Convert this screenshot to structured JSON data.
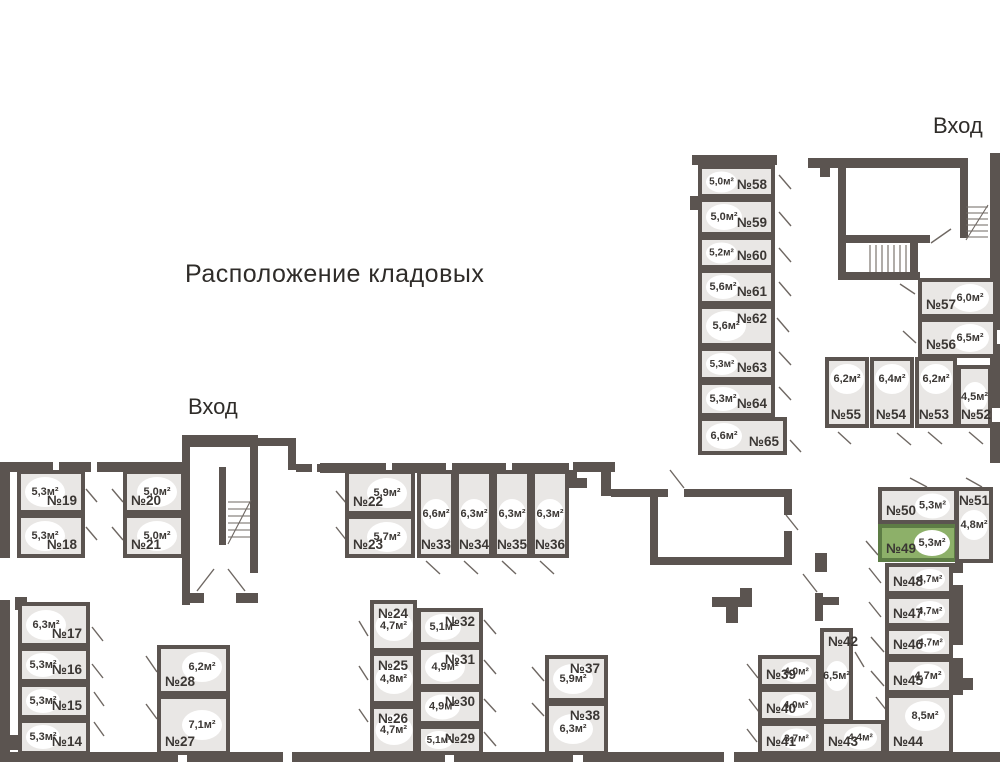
{
  "title": "Расположение кладовых",
  "entrances": {
    "top": "Вход",
    "left": "Вход"
  },
  "colors": {
    "wall": "#5b5450",
    "room_fill": "#e9e7e5",
    "selected_fill": "#8db069",
    "selected_border": "#5d7c45",
    "text": "#3b3734",
    "badge_fill": "#ffffff"
  },
  "selected_room": "№49",
  "rooms": [
    {
      "num": "№14",
      "area": "5,3м²",
      "x": 18,
      "y": 719,
      "w": 72,
      "h": 36,
      "np": "br",
      "ap": "cl"
    },
    {
      "num": "№15",
      "area": "5,3м²",
      "x": 18,
      "y": 683,
      "w": 72,
      "h": 36,
      "np": "br",
      "ap": "cl"
    },
    {
      "num": "№16",
      "area": "5,3м²",
      "x": 18,
      "y": 647,
      "w": 72,
      "h": 36,
      "np": "br",
      "ap": "cl"
    },
    {
      "num": "№17",
      "area": "6,3м²",
      "x": 18,
      "y": 602,
      "w": 72,
      "h": 45,
      "np": "br",
      "ap": "cl"
    },
    {
      "num": "№18",
      "area": "5,3м²",
      "x": 17,
      "y": 514,
      "w": 68,
      "h": 44,
      "np": "br",
      "ap": "cl"
    },
    {
      "num": "№19",
      "area": "5,3м²",
      "x": 17,
      "y": 470,
      "w": 68,
      "h": 44,
      "np": "br",
      "ap": "cl"
    },
    {
      "num": "№20",
      "area": "5,0м²",
      "x": 123,
      "y": 470,
      "w": 62,
      "h": 44,
      "np": "bl",
      "ap": "cr"
    },
    {
      "num": "№21",
      "area": "5,0м²",
      "x": 123,
      "y": 514,
      "w": 62,
      "h": 44,
      "np": "bl",
      "ap": "cr"
    },
    {
      "num": "№22",
      "area": "5,9м²",
      "x": 345,
      "y": 470,
      "w": 70,
      "h": 45,
      "np": "bl",
      "ap": "cr"
    },
    {
      "num": "№23",
      "area": "5,7м²",
      "x": 345,
      "y": 515,
      "w": 70,
      "h": 43,
      "np": "bl",
      "ap": "cr"
    },
    {
      "num": "№24",
      "area": "4,7м²",
      "x": 370,
      "y": 600,
      "w": 47,
      "h": 52,
      "np": "tl",
      "ap": "c"
    },
    {
      "num": "№25",
      "area": "4,8м²",
      "x": 370,
      "y": 652,
      "w": 47,
      "h": 53,
      "np": "tl",
      "ap": "c"
    },
    {
      "num": "№26",
      "area": "4,7м²",
      "x": 370,
      "y": 705,
      "w": 47,
      "h": 50,
      "np": "tl",
      "ap": "c"
    },
    {
      "num": "№27",
      "area": "7,1м²",
      "x": 157,
      "y": 695,
      "w": 73,
      "h": 60,
      "np": "bl",
      "ap": "cr"
    },
    {
      "num": "№28",
      "area": "6,2м²",
      "x": 157,
      "y": 645,
      "w": 73,
      "h": 50,
      "np": "bl",
      "ap": "tr"
    },
    {
      "num": "№29",
      "area": "5,1м²",
      "x": 417,
      "y": 725,
      "w": 66,
      "h": 30,
      "np": "tr",
      "ap": "cl"
    },
    {
      "num": "№30",
      "area": "4,9м²",
      "x": 417,
      "y": 688,
      "w": 66,
      "h": 37,
      "np": "tr",
      "ap": "cl"
    },
    {
      "num": "№31",
      "area": "4,9м²",
      "x": 417,
      "y": 646,
      "w": 66,
      "h": 42,
      "np": "tr",
      "ap": "cl"
    },
    {
      "num": "№32",
      "area": "5,1м²",
      "x": 417,
      "y": 608,
      "w": 66,
      "h": 38,
      "np": "tr",
      "ap": "cl"
    },
    {
      "num": "№33",
      "area": "6,6м²",
      "x": 417,
      "y": 470,
      "w": 38,
      "h": 88,
      "np": "bc",
      "ap": "c"
    },
    {
      "num": "№34",
      "area": "6,3м²",
      "x": 455,
      "y": 470,
      "w": 38,
      "h": 88,
      "np": "bc",
      "ap": "c"
    },
    {
      "num": "№35",
      "area": "6,3м²",
      "x": 493,
      "y": 470,
      "w": 38,
      "h": 88,
      "np": "bc",
      "ap": "c"
    },
    {
      "num": "№36",
      "area": "6,3м²",
      "x": 531,
      "y": 470,
      "w": 38,
      "h": 88,
      "np": "bc",
      "ap": "c"
    },
    {
      "num": "№37",
      "area": "5,9м²",
      "x": 545,
      "y": 655,
      "w": 63,
      "h": 47,
      "np": "tr",
      "ap": "cl"
    },
    {
      "num": "№38",
      "area": "6,3м²",
      "x": 545,
      "y": 702,
      "w": 63,
      "h": 53,
      "np": "tr",
      "ap": "cl"
    },
    {
      "num": "№39",
      "area": "4,0м²",
      "x": 758,
      "y": 655,
      "w": 62,
      "h": 33,
      "np": "bl",
      "ap": "cr"
    },
    {
      "num": "№40",
      "area": "4,0м²",
      "x": 758,
      "y": 688,
      "w": 62,
      "h": 34,
      "np": "bl",
      "ap": "cr"
    },
    {
      "num": "№41",
      "area": "3,7м²",
      "x": 758,
      "y": 722,
      "w": 62,
      "h": 33,
      "np": "bl",
      "ap": "cr"
    },
    {
      "num": "№42",
      "area": "6,5м²",
      "x": 820,
      "y": 628,
      "w": 33,
      "h": 95,
      "np": "tl",
      "ap": "c"
    },
    {
      "num": "№43",
      "area": "4,4м²",
      "x": 820,
      "y": 720,
      "w": 65,
      "h": 35,
      "np": "bl",
      "ap": "cr"
    },
    {
      "num": "№44",
      "area": "8,5м²",
      "x": 885,
      "y": 694,
      "w": 68,
      "h": 61,
      "np": "bl",
      "ap": "tr"
    },
    {
      "num": "№45",
      "area": "4,7м²",
      "x": 885,
      "y": 658,
      "w": 68,
      "h": 36,
      "np": "bl",
      "ap": "cr"
    },
    {
      "num": "№46",
      "area": "4,7м²",
      "x": 885,
      "y": 627,
      "w": 68,
      "h": 31,
      "np": "bl",
      "ap": "cr"
    },
    {
      "num": "№47",
      "area": "4,7м²",
      "x": 885,
      "y": 595,
      "w": 68,
      "h": 32,
      "np": "bl",
      "ap": "cr"
    },
    {
      "num": "№48",
      "area": "4,7м²",
      "x": 885,
      "y": 563,
      "w": 68,
      "h": 32,
      "np": "bl",
      "ap": "cr"
    },
    {
      "num": "№49",
      "area": "5,3м²",
      "x": 878,
      "y": 524,
      "w": 80,
      "h": 38,
      "np": "bl",
      "ap": "cr",
      "selected": true
    },
    {
      "num": "№50",
      "area": "5,3м²",
      "x": 878,
      "y": 487,
      "w": 80,
      "h": 37,
      "np": "bl",
      "ap": "cr"
    },
    {
      "num": "№51",
      "area": "4,8м²",
      "x": 955,
      "y": 487,
      "w": 38,
      "h": 76,
      "np": "tc",
      "ap": "c"
    },
    {
      "num": "№52",
      "area": "4,5м²",
      "x": 957,
      "y": 365,
      "w": 35,
      "h": 63,
      "np": "bc",
      "ap": "c"
    },
    {
      "num": "№53",
      "area": "6,2м²",
      "x": 915,
      "y": 357,
      "w": 42,
      "h": 71,
      "np": "br",
      "ap": "tc"
    },
    {
      "num": "№54",
      "area": "6,4м²",
      "x": 870,
      "y": 357,
      "w": 44,
      "h": 71,
      "np": "br",
      "ap": "tc"
    },
    {
      "num": "№55",
      "area": "6,2м²",
      "x": 825,
      "y": 357,
      "w": 44,
      "h": 71,
      "np": "br",
      "ap": "tc"
    },
    {
      "num": "№56",
      "area": "6,5м²",
      "x": 918,
      "y": 318,
      "w": 79,
      "h": 40,
      "np": "bl",
      "ap": "cr"
    },
    {
      "num": "№57",
      "area": "6,0м²",
      "x": 918,
      "y": 278,
      "w": 79,
      "h": 40,
      "np": "bl",
      "ap": "cr"
    },
    {
      "num": "№58",
      "area": "5,0м²",
      "x": 698,
      "y": 165,
      "w": 77,
      "h": 33,
      "np": "br",
      "ap": "cl"
    },
    {
      "num": "№59",
      "area": "5,0м²",
      "x": 698,
      "y": 198,
      "w": 77,
      "h": 38,
      "np": "br",
      "ap": "cl"
    },
    {
      "num": "№60",
      "area": "5,2м²",
      "x": 698,
      "y": 236,
      "w": 77,
      "h": 33,
      "np": "br",
      "ap": "cl"
    },
    {
      "num": "№61",
      "area": "5,6м²",
      "x": 698,
      "y": 269,
      "w": 77,
      "h": 36,
      "np": "br",
      "ap": "cl"
    },
    {
      "num": "№62",
      "area": "5,6м²",
      "x": 698,
      "y": 305,
      "w": 77,
      "h": 42,
      "np": "tr",
      "ap": "cl"
    },
    {
      "num": "№63",
      "area": "5,3м²",
      "x": 698,
      "y": 347,
      "w": 77,
      "h": 34,
      "np": "br",
      "ap": "cl"
    },
    {
      "num": "№64",
      "area": "5,3м²",
      "x": 698,
      "y": 381,
      "w": 77,
      "h": 36,
      "np": "br",
      "ap": "cl"
    },
    {
      "num": "№65",
      "area": "6,6м²",
      "x": 698,
      "y": 417,
      "w": 89,
      "h": 38,
      "np": "br",
      "ap": "cl"
    }
  ]
}
